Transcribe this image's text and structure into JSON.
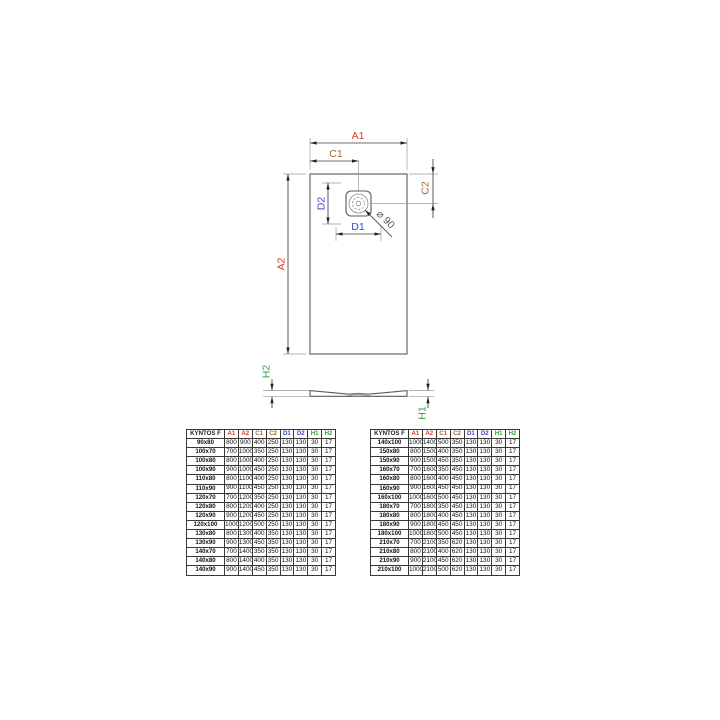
{
  "colors": {
    "a": "#df382b",
    "c": "#a9672f",
    "d": "#4146c8",
    "h": "#2fa43a",
    "line": "#5a5a5a",
    "thin": "#9a9a9a",
    "dark": "#222222",
    "border": "#383838"
  },
  "diagram": {
    "top_view": {
      "a1": "A1",
      "a2": "A2",
      "c1": "C1",
      "c2": "C2",
      "d1": "D1",
      "d2": "D2",
      "drain": "⌀ 90"
    },
    "side_view": {
      "h1": "H1",
      "h2": "H2"
    }
  },
  "tables": {
    "columns": [
      {
        "label": "KYNTOS F",
        "color": "dark"
      },
      {
        "label": "A1",
        "color": "a"
      },
      {
        "label": "A2",
        "color": "a"
      },
      {
        "label": "C1",
        "color": "c"
      },
      {
        "label": "C2",
        "color": "c"
      },
      {
        "label": "D1",
        "color": "d"
      },
      {
        "label": "D2",
        "color": "d"
      },
      {
        "label": "H1",
        "color": "h"
      },
      {
        "label": "H2",
        "color": "h"
      }
    ],
    "left": {
      "rows": [
        {
          "size": "90x80",
          "values": [
            "800",
            "900",
            "400",
            "250",
            "130",
            "130",
            "30",
            "17"
          ]
        },
        {
          "size": "100x70",
          "values": [
            "700",
            "1000",
            "350",
            "250",
            "130",
            "130",
            "30",
            "17"
          ]
        },
        {
          "size": "100x80",
          "values": [
            "800",
            "1000",
            "400",
            "250",
            "130",
            "130",
            "30",
            "17"
          ]
        },
        {
          "size": "100x90",
          "values": [
            "900",
            "1000",
            "450",
            "250",
            "130",
            "130",
            "30",
            "17"
          ]
        },
        {
          "size": "110x80",
          "values": [
            "800",
            "1100",
            "400",
            "250",
            "130",
            "130",
            "30",
            "17"
          ]
        },
        {
          "size": "110x90",
          "values": [
            "900",
            "1100",
            "450",
            "250",
            "130",
            "130",
            "30",
            "17"
          ]
        },
        {
          "size": "120x70",
          "values": [
            "700",
            "1200",
            "350",
            "250",
            "130",
            "130",
            "30",
            "17"
          ]
        },
        {
          "size": "120x80",
          "values": [
            "800",
            "1200",
            "400",
            "250",
            "130",
            "130",
            "30",
            "17"
          ]
        },
        {
          "size": "120x90",
          "values": [
            "900",
            "1200",
            "450",
            "250",
            "130",
            "130",
            "30",
            "17"
          ]
        },
        {
          "size": "120x100",
          "values": [
            "1000",
            "1200",
            "500",
            "250",
            "130",
            "130",
            "30",
            "17"
          ]
        },
        {
          "size": "130x80",
          "values": [
            "800",
            "1300",
            "400",
            "350",
            "130",
            "130",
            "30",
            "17"
          ]
        },
        {
          "size": "130x90",
          "values": [
            "900",
            "1300",
            "450",
            "350",
            "130",
            "130",
            "30",
            "17"
          ]
        },
        {
          "size": "140x70",
          "values": [
            "700",
            "1400",
            "350",
            "350",
            "130",
            "130",
            "30",
            "17"
          ]
        },
        {
          "size": "140x80",
          "values": [
            "800",
            "1400",
            "400",
            "350",
            "130",
            "130",
            "30",
            "17"
          ]
        },
        {
          "size": "140x90",
          "values": [
            "900",
            "1400",
            "450",
            "350",
            "130",
            "130",
            "30",
            "17"
          ]
        }
      ]
    },
    "right": {
      "rows": [
        {
          "size": "140x100",
          "values": [
            "1000",
            "1400",
            "500",
            "350",
            "130",
            "130",
            "30",
            "17"
          ]
        },
        {
          "size": "150x80",
          "values": [
            "800",
            "1500",
            "400",
            "350",
            "130",
            "130",
            "30",
            "17"
          ]
        },
        {
          "size": "150x90",
          "values": [
            "900",
            "1500",
            "450",
            "350",
            "130",
            "130",
            "30",
            "17"
          ]
        },
        {
          "size": "160x70",
          "values": [
            "700",
            "1600",
            "350",
            "450",
            "130",
            "130",
            "30",
            "17"
          ]
        },
        {
          "size": "160x80",
          "values": [
            "800",
            "1600",
            "400",
            "450",
            "130",
            "130",
            "30",
            "17"
          ]
        },
        {
          "size": "160x90",
          "values": [
            "900",
            "1600",
            "450",
            "450",
            "130",
            "130",
            "30",
            "17"
          ]
        },
        {
          "size": "160x100",
          "values": [
            "1000",
            "1600",
            "500",
            "450",
            "130",
            "130",
            "30",
            "17"
          ]
        },
        {
          "size": "180x70",
          "values": [
            "700",
            "1800",
            "350",
            "450",
            "130",
            "130",
            "30",
            "17"
          ]
        },
        {
          "size": "180x80",
          "values": [
            "800",
            "1800",
            "400",
            "450",
            "130",
            "130",
            "30",
            "17"
          ]
        },
        {
          "size": "180x90",
          "values": [
            "900",
            "1800",
            "450",
            "450",
            "130",
            "130",
            "30",
            "17"
          ]
        },
        {
          "size": "180x100",
          "values": [
            "1000",
            "1800",
            "500",
            "450",
            "130",
            "130",
            "30",
            "17"
          ]
        },
        {
          "size": "210x70",
          "values": [
            "700",
            "2100",
            "350",
            "620",
            "130",
            "130",
            "30",
            "17"
          ]
        },
        {
          "size": "210x80",
          "values": [
            "800",
            "2100",
            "400",
            "620",
            "130",
            "130",
            "30",
            "17"
          ]
        },
        {
          "size": "210x90",
          "values": [
            "900",
            "2100",
            "450",
            "620",
            "130",
            "130",
            "30",
            "17"
          ]
        },
        {
          "size": "210x100",
          "values": [
            "1000",
            "2100",
            "500",
            "620",
            "130",
            "130",
            "30",
            "17"
          ]
        }
      ]
    }
  }
}
